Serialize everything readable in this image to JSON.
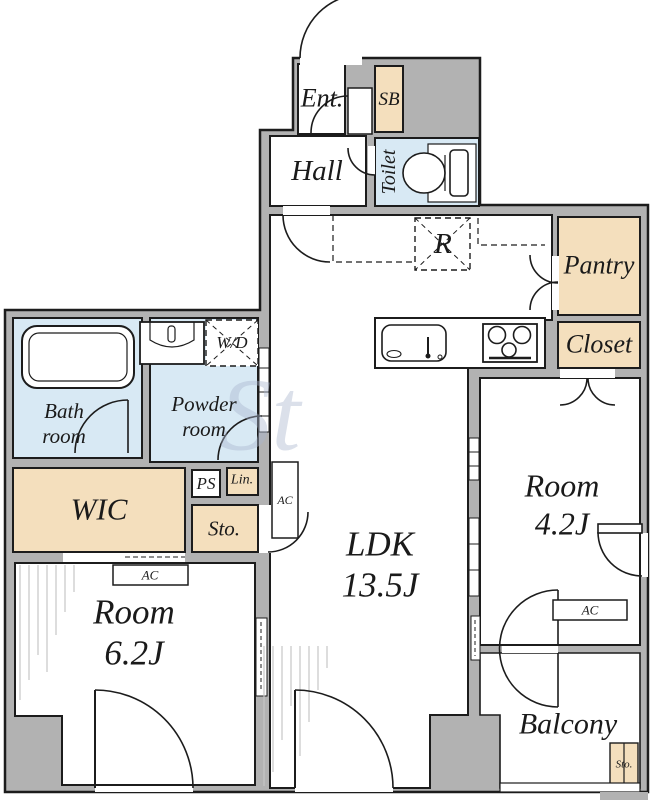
{
  "plan_title": "apartment-floor-plan",
  "rooms": {
    "entrance": {
      "label": "Ent."
    },
    "shoe_box": {
      "label": "SB"
    },
    "hall": {
      "label": "Hall"
    },
    "toilet": {
      "label": "Toilet"
    },
    "pantry": {
      "label": "Pantry"
    },
    "closet": {
      "label": "Closet"
    },
    "bath": {
      "label": "Bath\nroom"
    },
    "powder": {
      "label": "Powder\nroom"
    },
    "wic": {
      "label": "WIC"
    },
    "pipe_space": {
      "label": "PS"
    },
    "linen": {
      "label": "Lin."
    },
    "storage": {
      "label": "Sto."
    },
    "ldk": {
      "label": "LDK\n13.5J",
      "name": "LDK",
      "size": "13.5J"
    },
    "room_right": {
      "label": "Room\n4.2J",
      "name": "Room",
      "size": "4.2J"
    },
    "room_left": {
      "label": "Room\n6.2J",
      "name": "Room",
      "size": "6.2J"
    },
    "balcony": {
      "label": "Balcony"
    },
    "balcony_storage": {
      "label": "Sto."
    }
  },
  "equipment": {
    "washer_dryer": "W/D",
    "refrigerator": "R",
    "air_conditioner": "AC"
  },
  "watermark": "St",
  "colors": {
    "wall_gray": "#b2b2b2",
    "storage_tan": "#f4dfbd",
    "wet_area_blue": "#d8e9f4",
    "outline_black": "#1c1c1c",
    "room_white": "#ffffff"
  }
}
